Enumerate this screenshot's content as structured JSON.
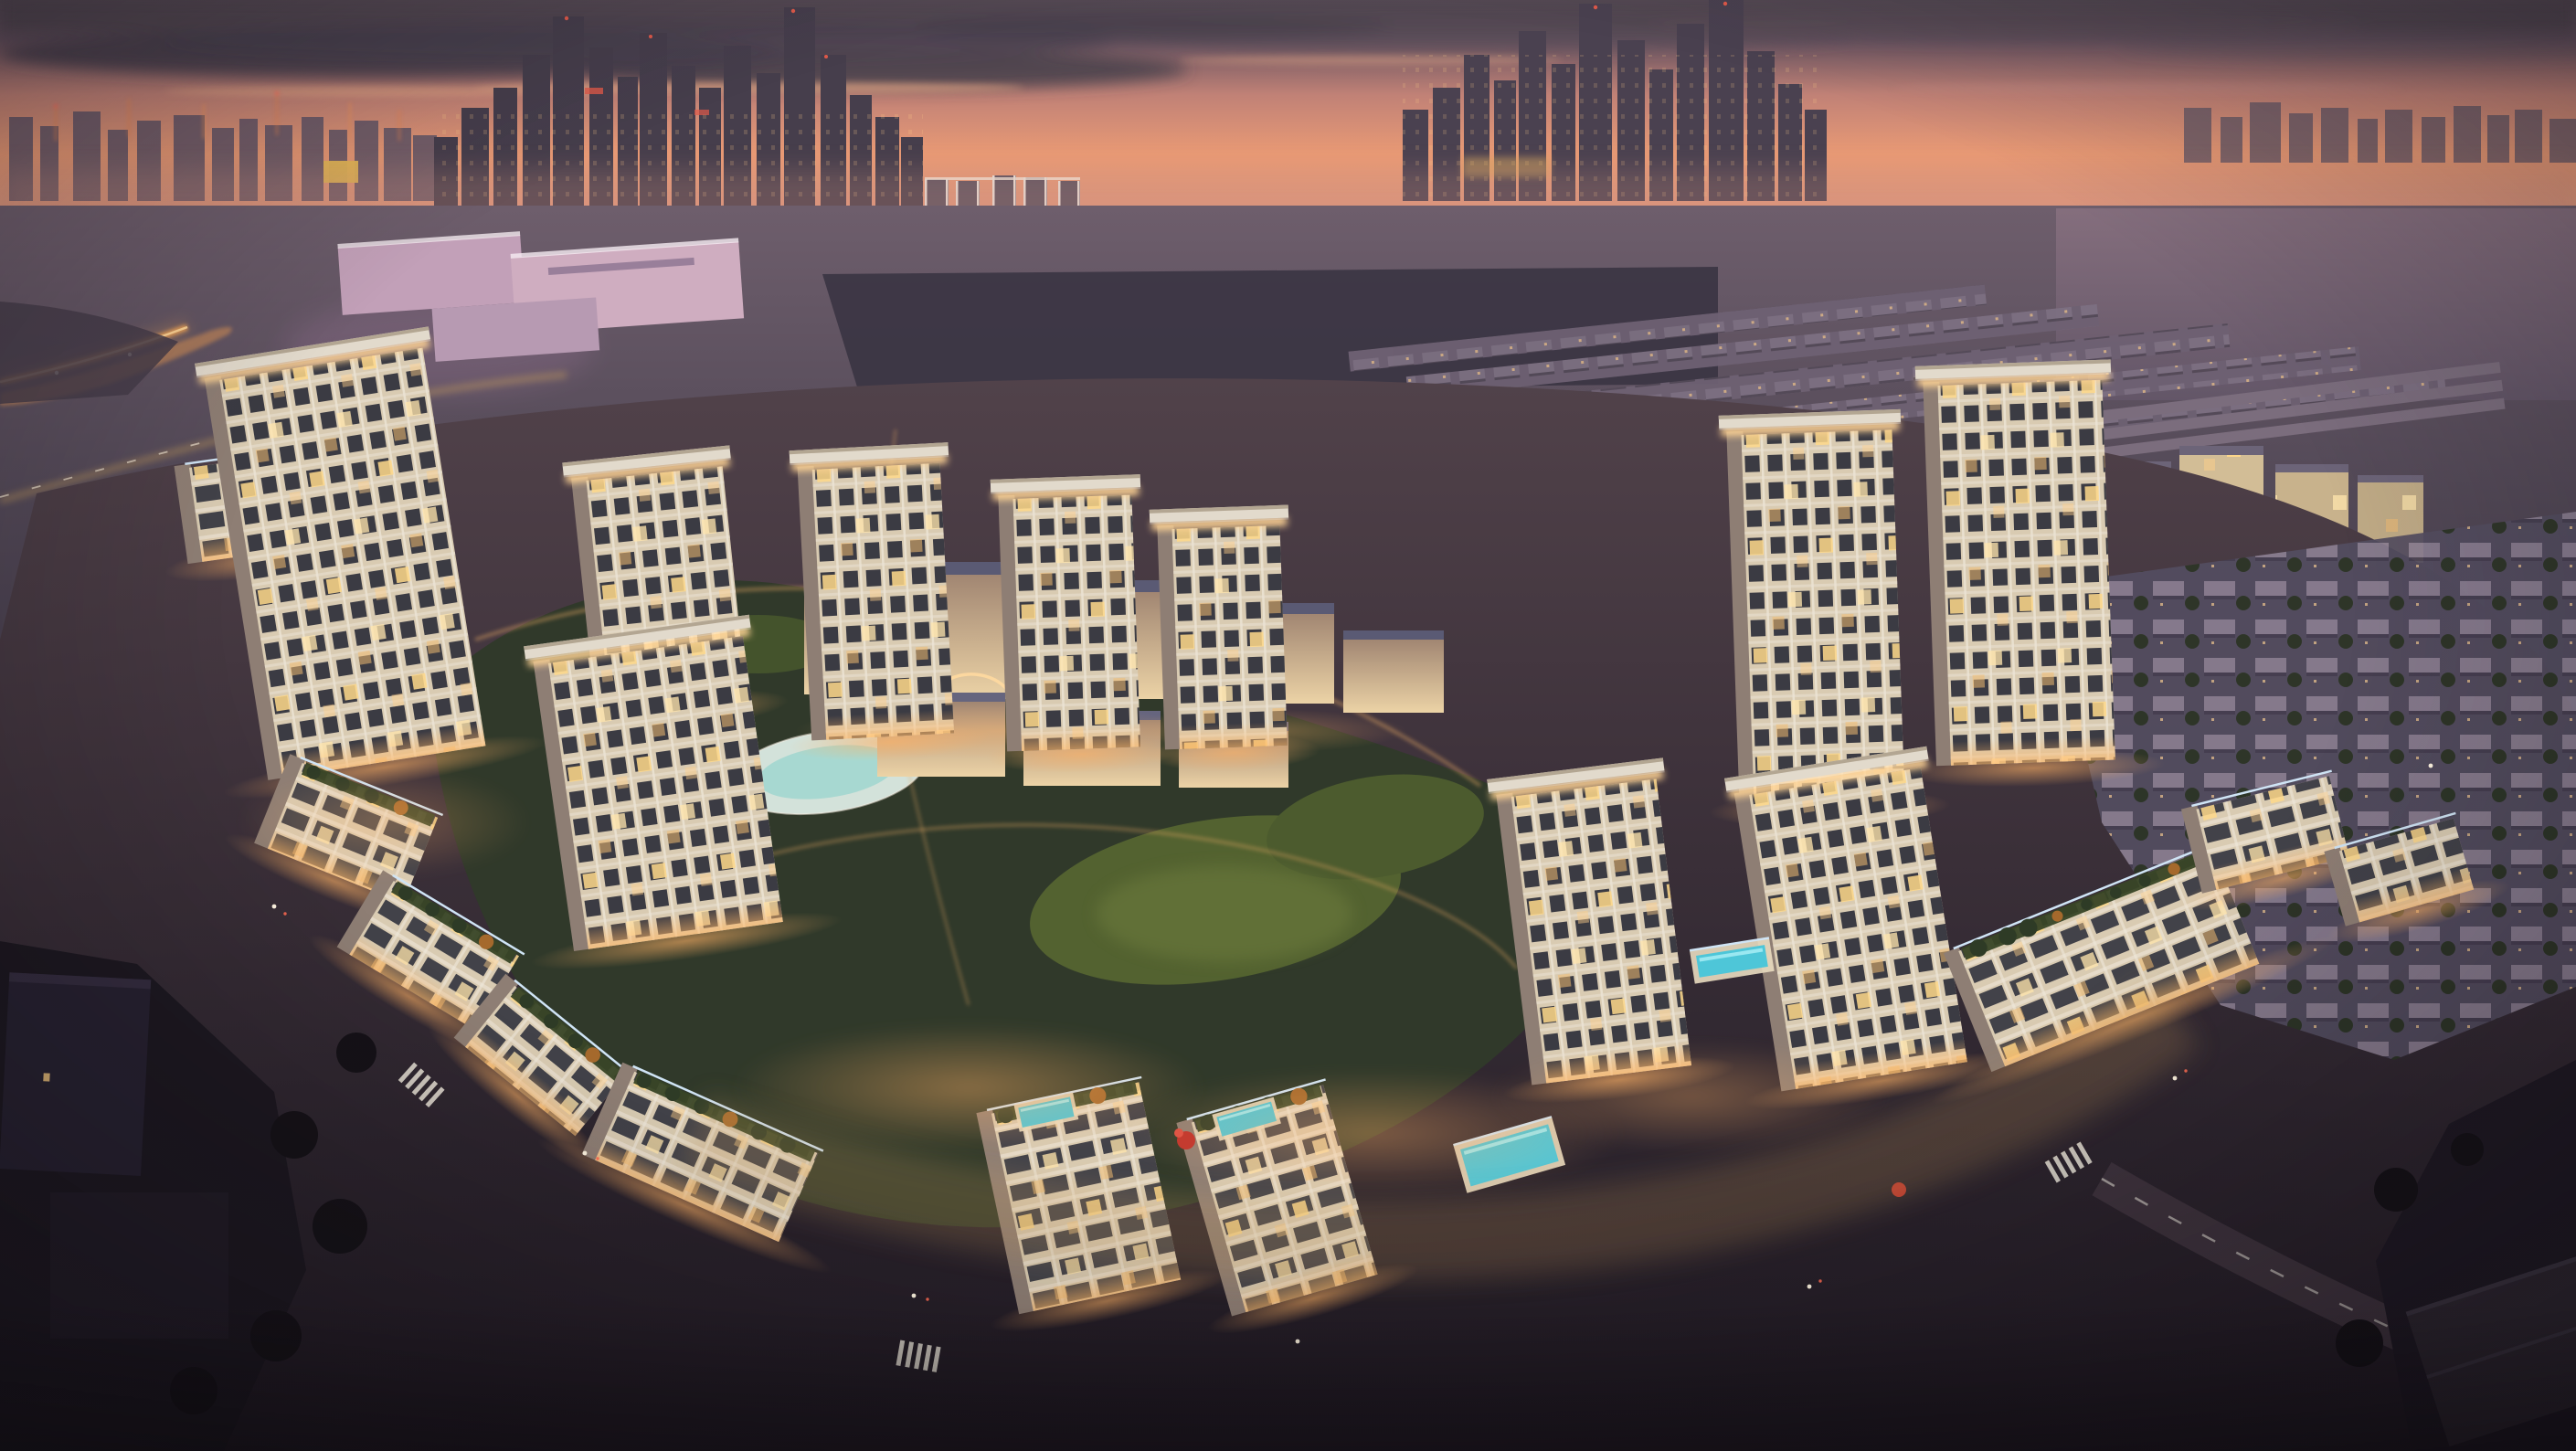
{
  "scene": {
    "type": "aerial-architectural-rendering",
    "time_of_day": "dusk",
    "subject": "illuminated residential community with ring boulevard, central park and distant city skyline"
  },
  "signs": {
    "ikea": "IKEA",
    "ace": "ACE"
  },
  "palette": {
    "sky_top": "#574b56",
    "sky_band": "#665260",
    "sky_glow": "#e99a75",
    "sky_rose": "#cd9189",
    "sky_haze": "#99808f",
    "cloud_dark": "#463d4a",
    "cloud_lit": "#f2b48b",
    "skyline_far": "#6b5a68",
    "skyline_main": "#463e4c",
    "window_warm": "#ffcc85",
    "light_bright": "#ffe7b8",
    "glow_warm": "#ffb266",
    "road_glow": "#e89a55",
    "mall_wall": "#ecd3a6",
    "mall_roof": "#5a5a74",
    "shed_pink": "#c7a2b6",
    "suburb": "#6e6173",
    "park_dark": "#30392a",
    "park_lawn": "#556430",
    "tree_dark": "#253020",
    "tree_autumn": "#b5772e",
    "pond": "#dcebe4",
    "pool": "#4ec6d8",
    "asphalt": "#3e333d",
    "lane_mark": "#e8e3d8",
    "palm_green": "#3f5230",
    "facade_light": "#d9cbb2",
    "facade_shadow": "#8e7e74",
    "window_dark": "#2e2f3a",
    "cornice": "#ffd495",
    "roof_slab": "#e2dacc",
    "roof_edge": "#b3a692",
    "led_edge": "#cfe4f5",
    "red_accent": "#c43b2f",
    "dark_corner": "#1c1820",
    "sign_ikea_bg": "#1d2f63",
    "sign_ikea_text": "#f7c61a",
    "sign_ace_bg": "#b5342c"
  }
}
